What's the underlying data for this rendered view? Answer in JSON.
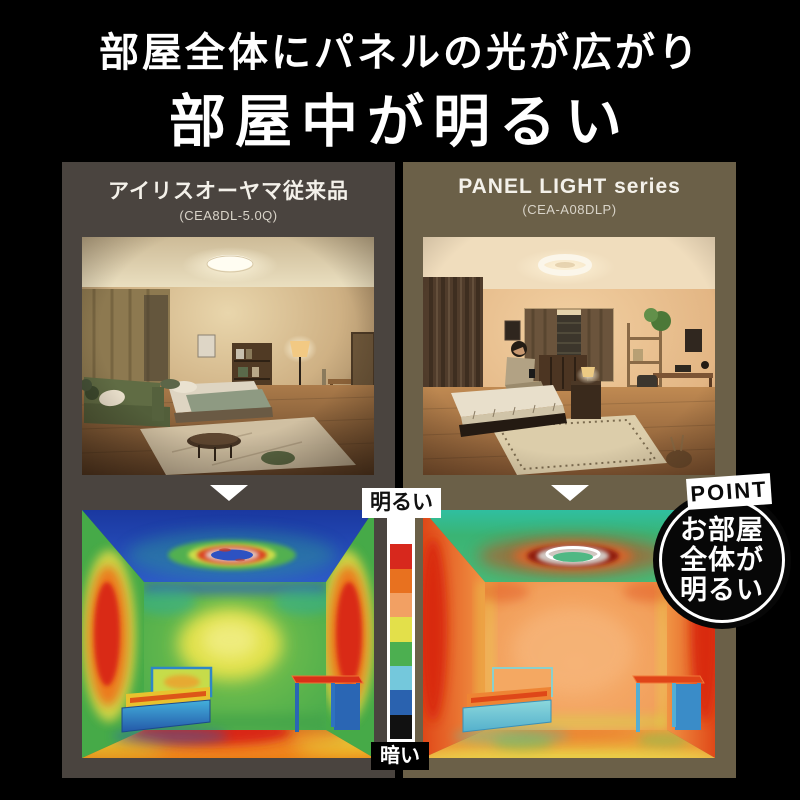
{
  "page": {
    "background": "#000000"
  },
  "headline": {
    "line1": "部屋全体にパネルの光が広がり",
    "line2": "部屋中が明るい"
  },
  "panels": {
    "conventional": {
      "name": "アイリスオーヤマ従来品",
      "model": "(CEA8DL-5.0Q)",
      "bg_color": "#4a443f"
    },
    "panel_light": {
      "name": "PANEL LIGHT series",
      "model": "(CEA-A08DLP)",
      "bg_color": "#6b6048"
    }
  },
  "brightness_scale": {
    "bright_label": "明るい",
    "dark_label": "暗い",
    "colors_top_to_bottom": [
      "#ffffff",
      "#d7281d",
      "#e8711f",
      "#f2a063",
      "#e3e04a",
      "#4caf50",
      "#74c8dc",
      "#2a62af",
      "#111111"
    ]
  },
  "point_badge": {
    "label": "POINT",
    "lines": [
      "お部屋",
      "全体が",
      "明るい"
    ]
  },
  "icons": {
    "down_arrow": "triangle-down"
  }
}
